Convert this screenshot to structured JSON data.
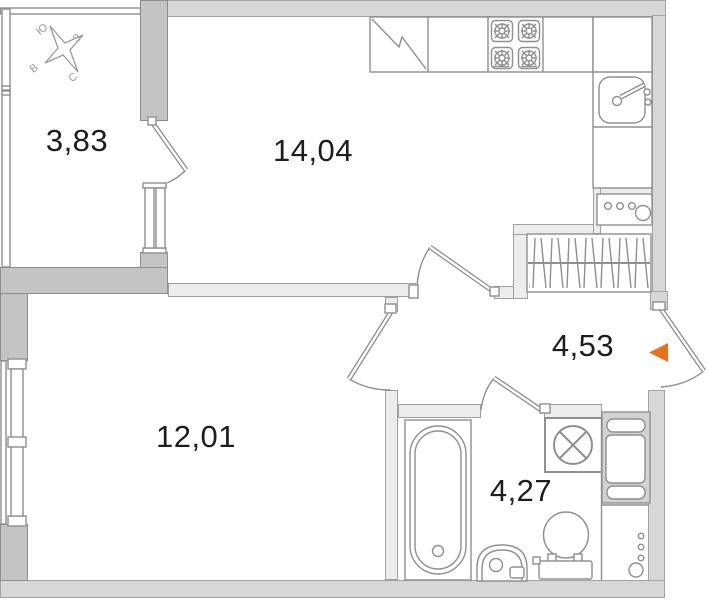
{
  "floor_plan": {
    "rooms": {
      "balcony": {
        "label": "3,83"
      },
      "kitchen_living": {
        "label": "14,04"
      },
      "bedroom": {
        "label": "12,01"
      },
      "hallway": {
        "label": "4,53"
      },
      "bathroom": {
        "label": "4,27"
      }
    },
    "compass": {
      "north": "С",
      "south": "Ю",
      "east": "В",
      "west": "З"
    },
    "colors": {
      "entrance_arrow": "#e8711e"
    }
  }
}
